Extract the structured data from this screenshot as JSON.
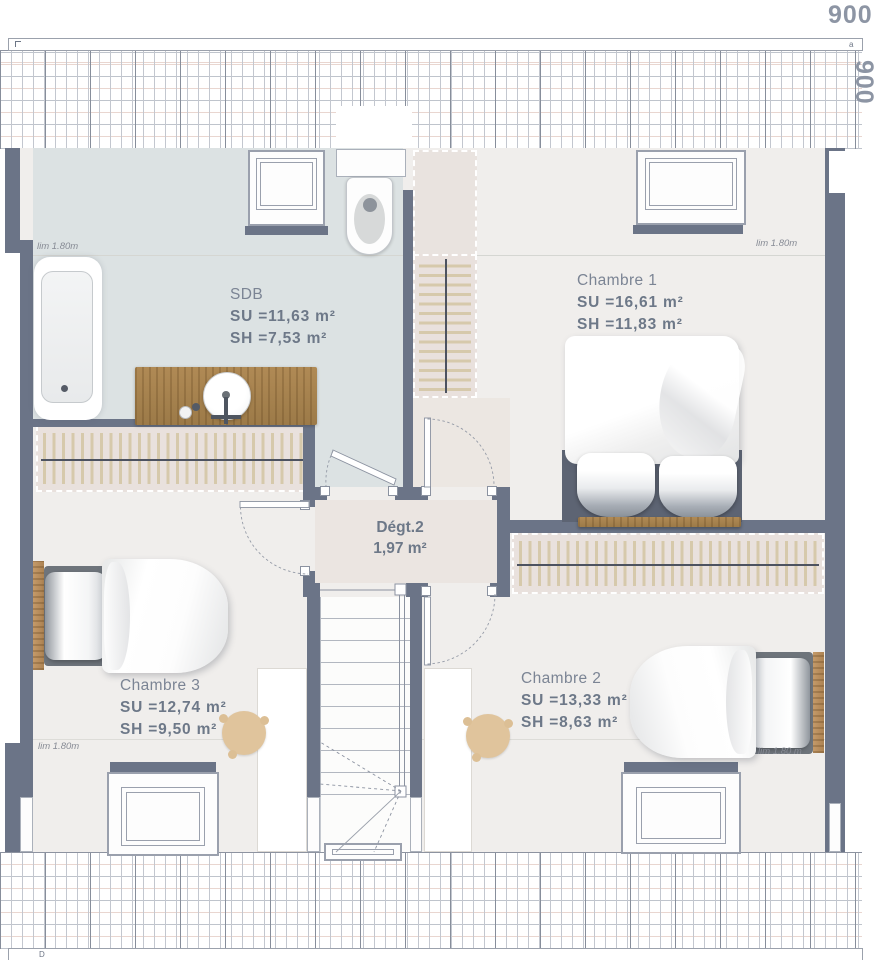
{
  "dimensions": {
    "top": "900",
    "right": "900",
    "top_mark": "a",
    "bottom_mark": "D"
  },
  "rooms": {
    "sdb": {
      "name": "SDB",
      "su": "SU =11,63 m²",
      "sh": "SH =7,53 m²"
    },
    "chambre1": {
      "name": "Chambre 1",
      "su": "SU =16,61 m²",
      "sh": "SH =11,83 m²"
    },
    "chambre2": {
      "name": "Chambre 2",
      "su": "SU =13,33 m²",
      "sh": "SH =8,63 m²"
    },
    "chambre3": {
      "name": "Chambre 3",
      "su": "SU =12,74 m²",
      "sh": "SH =9,50 m²"
    },
    "degt2": {
      "name": "Dégt.2",
      "area": "1,97 m²"
    }
  },
  "limits": {
    "sdb": "lim 1.80m",
    "chambre1": "lim 1.80m",
    "chambre3": "lim 1.80m",
    "chambre2": "lim 1.80 m"
  },
  "colors": {
    "wall": "#6b7487",
    "sdb_floor": "#dce2e3",
    "room_floor": "#f0eeec",
    "hall_floor": "#ece6e2",
    "wardrobe_fill": "#e9e1dd",
    "wardrobe_stroke": "#d6c9ab",
    "wood": "#ad8753",
    "label_text": "#6d7888"
  }
}
